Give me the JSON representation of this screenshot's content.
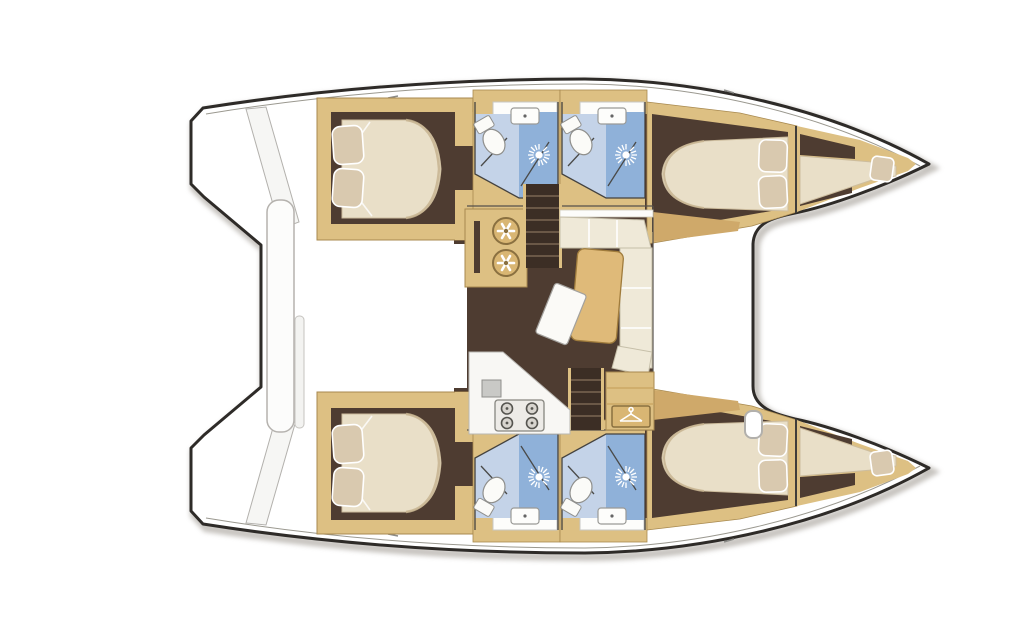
{
  "page": {
    "background": "#ffffff"
  },
  "diagram": {
    "type": "boat-floor-plan",
    "vessel": "sailing catamaran",
    "view": "overhead interior layout plan",
    "orientation": {
      "bow": "right",
      "stern": "left"
    },
    "bridge_deck": {
      "areas": [
        "saloon with L-shaped sofa and dining table",
        "galley unit with twin round sinks",
        "galley counter with four-burner stove",
        "wardrobe locker with clothes-hanger sign",
        "companionway stairs to upper hull",
        "companionway stairs to lower hull",
        "tilted chart seat"
      ]
    },
    "hulls": [
      {
        "id": "upper-hull",
        "rooms": [
          "aft double cabin with two pillows",
          "head with shower",
          "head with shower",
          "forward double cabin with two pillows",
          "forepeak berth with pillow"
        ]
      },
      {
        "id": "lower-hull",
        "rooms": [
          "aft double cabin with two pillows",
          "head with shower",
          "head with shower",
          "forward double cabin with two pillows",
          "forepeak berth with pillow"
        ]
      }
    ],
    "stern_features": [
      "transom steps",
      "center cockpit bench"
    ],
    "bow_features": [
      "foredeck edge line",
      "bow tab fitting"
    ]
  },
  "icons": {
    "shower": "shower-rose-icon",
    "toilet": "toilet-icon",
    "basin": "washbasin-icon",
    "galley_sinks": "twin-round-sinks-icon",
    "stove": "four-burner-stove-icon",
    "hanger": "clothes-hanger-icon"
  },
  "colors": {
    "outline": "#2e2b28",
    "shadow": "#bdb9b4",
    "deck_line": "#9a988f",
    "white_deck": "#ffffff",
    "wood": "#ddc083",
    "wood_edge": "#a8894f",
    "wood_dark": "#cfa96a",
    "floor": "#4e3c31",
    "bed": "#e9dfc8",
    "bed_shade": "#cdbd9e",
    "pillow": "#d9c9af",
    "bath_floor": "#c4d3e8",
    "shower_floor": "#8fb1d9",
    "fixture": "#fbfbf8",
    "fixture_edge": "#8f8f8c",
    "sofa": "#efe9d8",
    "sofa_edge": "#c6bfa9",
    "table": "#dfba79",
    "stairs": "#3c2e25",
    "stair_step": "#6b5847",
    "steel": "#c9c9c6"
  }
}
